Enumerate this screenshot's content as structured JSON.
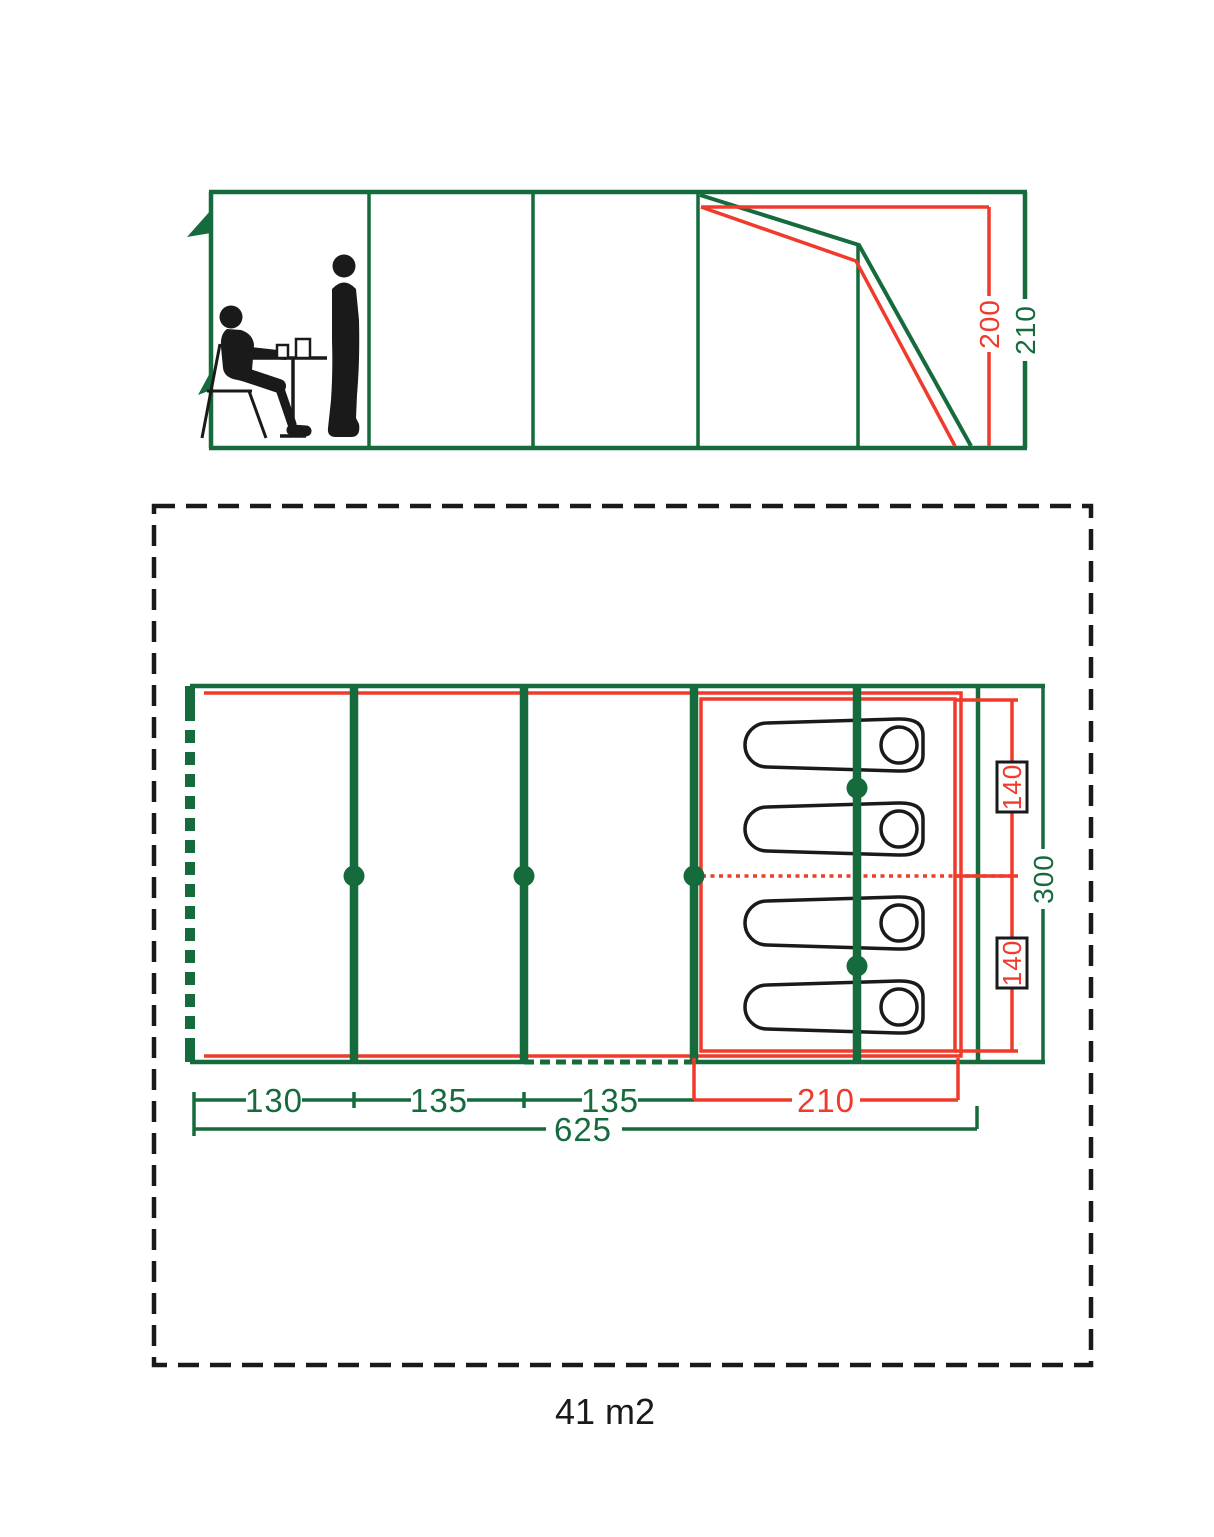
{
  "colors": {
    "green": "#156B3C",
    "red": "#F03A2B",
    "ink": "#1A1A1A"
  },
  "elevation": {
    "inner_height_label": "200",
    "outer_height_label": "210"
  },
  "floorplan": {
    "segment_labels": [
      "130",
      "135",
      "135"
    ],
    "bedroom_length_label": "210",
    "total_length_label": "625",
    "bed_width_labels": [
      "140",
      "140"
    ],
    "width_label": "300"
  },
  "caption": {
    "area_label": "41 m2"
  }
}
